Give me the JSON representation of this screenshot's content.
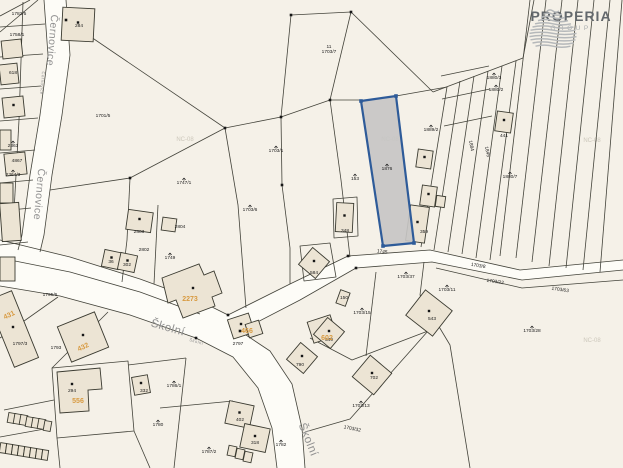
{
  "logo": {
    "name": "PROPERIA",
    "sub": "GROUP"
  },
  "map": {
    "colors": {
      "background": "#f5f1e8",
      "road_fill": "#fdfcf7",
      "parcel_line": "#43433a",
      "building_fill": "#ece4d4",
      "building_stroke": "#3a3a30",
      "label_black": "#1a1a1a",
      "label_orange": "#d89a40",
      "street_gray": "#909090",
      "watermark": "#ccc7bb",
      "highlight_fill": "#c7c6c4",
      "highlight_stroke": "#2e5b99"
    },
    "road_fills": [
      "M44,0 L66,0 L70,55 L62,115 L52,175 L44,235 L40,252 L18,250 L22,235 L30,175 L40,115 L48,55 Z",
      "M0,240 L70,257 L140,279 L200,301 L228,315 L290,284 L348,256 L356,268 L300,300 L240,331 L270,351 L292,384 L302,428 L305,468 L277,468 L272,428 L258,388 L233,357 L196,338 L130,315 L60,296 L0,286 Z",
      "M348,256 L430,250 L520,270 L623,260 L623,270 L522,280 L432,262 L356,268 Z"
    ],
    "lines": [
      "M44,0 L48,55 L40,115 L30,175 L22,235 L18,250",
      "M66,0 L70,55 L62,115 L52,175 L44,235 L40,252",
      "M0,240 L70,257 L140,279 L200,301 L228,315",
      "M0,286 L60,296 L130,315 L196,338",
      "M0,258 L70,272 L140,292 L200,314",
      "M228,315 L290,284 L348,256",
      "M240,331 L300,300 L356,268",
      "M196,338 L233,357 L258,388 L272,428 L277,468",
      "M240,331 L270,351 L292,384 L302,428 L305,468",
      "M348,256 L430,250 L520,270 L623,260",
      "M356,268 L432,262 L522,280 L623,270",
      "M0,27 L45,24",
      "M0,57 L43,54",
      "M0,89 L41,86",
      "M0,121 L38,118",
      "M0,153 L35,150",
      "M0,183 L33,180",
      "M0,211 L31,208",
      "M0,245 L28,242",
      "M23,2 L19,120",
      "M19,120 L13,230",
      "M0,16 L30,0",
      "M0,32 L38,0",
      "M291,15 L351,12 L330,100 L281,117 Z",
      "M66,20 L225,128",
      "M225,128 L281,117",
      "M330,100 L362,100",
      "M396,96 L447,87",
      "M351,12 L433,92",
      "M433,92 L523,58 L534,0",
      "M225,128 L130,178",
      "M130,178 L50,190",
      "M130,178 L127,240",
      "M127,240 L122,282",
      "M158,205 L154,284",
      "M225,128 L238,205 L246,308",
      "M281,117 L282,185 L290,248 L290,284",
      "M330,100 L341,180 L350,257",
      "M447,87 L421,247",
      "M460,81 L434,250",
      "M474,76 L448,252",
      "M488,71 L462,254",
      "M502,66 L476,258",
      "M516,61 L490,260",
      "M530,0 L500,256",
      "M546,0 L516,258",
      "M562,0 L532,262",
      "M578,0 L549,266",
      "M594,0 L566,268",
      "M610,0 L583,270",
      "M622,0 L600,272",
      "M441,76 L489,66",
      "M442,99 L490,89",
      "M444,126 L492,116",
      "M424,262 L420,295 L450,345 L470,468",
      "M376,272 L366,356",
      "M310,338 L352,360 L428,331",
      "M305,432 L350,419 L428,331",
      "M436,268 L522,288 L623,280",
      "M186,358 L174,468",
      "M128,365 L186,358",
      "M160,408 L233,401",
      "M52,368 L128,361 L134,431 L57,438 Z",
      "M134,431 L150,468",
      "M57,438 L60,468",
      "M58,297 L0,338",
      "M108,312 L52,368",
      "M4,410 L54,400",
      "M0,437 L50,428",
      "M300,246 L330,243 L336,277 L304,281 Z",
      "M333,199 L357,197 L358,236 L334,238 Z"
    ],
    "buildings": [
      {
        "x": 62,
        "y": 8,
        "w": 32,
        "h": 33,
        "rot": 3,
        "dot": 1
      },
      {
        "x": 2,
        "y": 40,
        "w": 20,
        "h": 18,
        "rot": -6
      },
      {
        "x": 0,
        "y": 64,
        "w": 18,
        "h": 20,
        "rot": -6
      },
      {
        "x": 3,
        "y": 97,
        "w": 21,
        "h": 20,
        "rot": -6,
        "dot": 1
      },
      {
        "x": 0,
        "y": 130,
        "w": 11,
        "h": 20,
        "rot": 0
      },
      {
        "x": 5,
        "y": 153,
        "w": 21,
        "h": 22,
        "rot": -6
      },
      {
        "x": 0,
        "y": 183,
        "w": 13,
        "h": 20,
        "rot": 0
      },
      {
        "x": 1,
        "y": 203,
        "w": 19,
        "h": 38,
        "rot": -4
      },
      {
        "x": 0,
        "y": 257,
        "w": 15,
        "h": 24,
        "rot": 0
      },
      {
        "x": 127,
        "y": 211,
        "w": 25,
        "h": 20,
        "rot": 8,
        "dot": 1
      },
      {
        "x": 162,
        "y": 218,
        "w": 14,
        "h": 13,
        "rot": 8
      },
      {
        "x": 103,
        "y": 251,
        "w": 17,
        "h": 17,
        "rot": 12,
        "dot": 1
      },
      {
        "x": 119,
        "y": 254,
        "w": 17,
        "h": 17,
        "rot": 12,
        "dot": 1
      },
      {
        "x": 417,
        "y": 150,
        "w": 15,
        "h": 18,
        "rot": 8,
        "dot": 1
      },
      {
        "x": 421,
        "y": 186,
        "w": 15,
        "h": 20,
        "rot": 8,
        "dot": 1
      },
      {
        "x": 408,
        "y": 206,
        "w": 19,
        "h": 36,
        "rot": 8,
        "dot": 1
      },
      {
        "x": 436,
        "y": 196,
        "w": 9,
        "h": 11,
        "rot": 8
      },
      {
        "x": 496,
        "y": 112,
        "w": 16,
        "h": 20,
        "rot": 8,
        "dot": 1
      },
      {
        "x": 336,
        "y": 203,
        "w": 17,
        "h": 29,
        "rot": 3,
        "dot": 1
      },
      {
        "x": 338,
        "y": 291,
        "w": 10,
        "h": 14,
        "rot": 20
      },
      {
        "x": 227,
        "y": 403,
        "w": 25,
        "h": 23,
        "rot": 12,
        "dot": 1
      },
      {
        "x": 242,
        "y": 426,
        "w": 26,
        "h": 24,
        "rot": 12,
        "dot": 1
      },
      {
        "x": 228,
        "y": 446,
        "w": 8,
        "h": 10,
        "rot": 12
      },
      {
        "x": 236,
        "y": 449,
        "w": 8,
        "h": 10,
        "rot": 12
      },
      {
        "x": 244,
        "y": 452,
        "w": 8,
        "h": 10,
        "rot": 12
      },
      {
        "x": 0,
        "y": 293,
        "w": 26,
        "h": 72,
        "rot": -22,
        "dot": 1
      },
      {
        "x": 63,
        "y": 318,
        "w": 40,
        "h": 38,
        "rot": -22,
        "dot": 1
      },
      {
        "x": 133,
        "y": 376,
        "w": 16,
        "h": 18,
        "rot": -10,
        "dot": 1
      },
      {
        "x": 230,
        "y": 316,
        "w": 22,
        "h": 20,
        "rot": -18,
        "dot": 1
      },
      {
        "x": 247,
        "y": 322,
        "w": 14,
        "h": 14,
        "rot": -18
      },
      {
        "x": 310,
        "y": 318,
        "w": 24,
        "h": 22,
        "rot": -18,
        "dot": 1
      },
      {
        "x": 291,
        "y": 347,
        "w": 22,
        "h": 22,
        "rot": 40,
        "dot": 1
      },
      {
        "x": 303,
        "y": 252,
        "w": 22,
        "h": 22,
        "rot": 40,
        "dot": 1
      },
      {
        "x": 412,
        "y": 297,
        "w": 34,
        "h": 32,
        "rot": 38,
        "dot": 1
      },
      {
        "x": 318,
        "y": 322,
        "w": 22,
        "h": 22,
        "rot": 40,
        "dot": 1
      },
      {
        "x": 358,
        "y": 361,
        "w": 28,
        "h": 28,
        "rot": 40,
        "dot": 1
      },
      {
        "x": 8,
        "y": 413,
        "w": 7,
        "h": 10,
        "rot": 10
      },
      {
        "x": 14,
        "y": 414,
        "w": 7,
        "h": 10,
        "rot": 10
      },
      {
        "x": 20,
        "y": 415,
        "w": 7,
        "h": 10,
        "rot": 10
      },
      {
        "x": 26,
        "y": 417,
        "w": 7,
        "h": 10,
        "rot": 10
      },
      {
        "x": 32,
        "y": 418,
        "w": 7,
        "h": 10,
        "rot": 10
      },
      {
        "x": 38,
        "y": 419,
        "w": 7,
        "h": 10,
        "rot": 10
      },
      {
        "x": 44,
        "y": 421,
        "w": 7,
        "h": 10,
        "rot": 10
      },
      {
        "x": 0,
        "y": 443,
        "w": 6,
        "h": 10,
        "rot": 8
      },
      {
        "x": 6,
        "y": 444,
        "w": 6,
        "h": 10,
        "rot": 8
      },
      {
        "x": 12,
        "y": 445,
        "w": 6,
        "h": 10,
        "rot": 8
      },
      {
        "x": 18,
        "y": 446,
        "w": 6,
        "h": 10,
        "rot": 8
      },
      {
        "x": 24,
        "y": 447,
        "w": 6,
        "h": 10,
        "rot": 8
      },
      {
        "x": 30,
        "y": 448,
        "w": 6,
        "h": 10,
        "rot": 8
      },
      {
        "x": 36,
        "y": 449,
        "w": 6,
        "h": 10,
        "rot": 8
      },
      {
        "x": 42,
        "y": 450,
        "w": 6,
        "h": 10,
        "rot": 8
      }
    ],
    "building_polys": [
      {
        "d": "M162,278 L199,264 L204,275 L214,271 L222,293 L212,297 L215,306 L183,318 L176,300 L168,303 Z",
        "dot_x": 193,
        "dot_y": 288
      },
      {
        "d": "M57,372 L100,368 L102,389 L88,390 L89,411 L60,413 Z",
        "dot_x": 72,
        "dot_y": 384
      }
    ],
    "vertices": [
      [
        291,
        15
      ],
      [
        351,
        12
      ],
      [
        330,
        100
      ],
      [
        281,
        117
      ],
      [
        225,
        128
      ],
      [
        66,
        20
      ],
      [
        228,
        315
      ],
      [
        240,
        331
      ],
      [
        348,
        256
      ],
      [
        356,
        268
      ],
      [
        196,
        338
      ],
      [
        282,
        185
      ],
      [
        130,
        178
      ]
    ],
    "highlight": {
      "points": "361,101 396,96 414,243 383,246",
      "nodes": [
        [
          361,
          101
        ],
        [
          396,
          96
        ],
        [
          414,
          243
        ],
        [
          383,
          246
        ]
      ]
    }
  },
  "streets": [
    {
      "text": "Černovice",
      "x": 49,
      "y": 40,
      "rot": 95,
      "size": 10.5
    },
    {
      "text": "Černovice",
      "x": 36,
      "y": 194,
      "rot": 95,
      "size": 10.5
    },
    {
      "text": "Černovice",
      "x": 41,
      "y": 83,
      "rot": 95,
      "size": 4.2
    },
    {
      "text": "Školní",
      "x": 167,
      "y": 331,
      "rot": 16,
      "size": 11.5
    },
    {
      "text": "Školní",
      "x": 196,
      "y": 343,
      "rot": 16,
      "size": 4.2
    },
    {
      "text": "Školní",
      "x": 305,
      "y": 441,
      "rot": 68,
      "size": 11.5
    }
  ],
  "watermarks": [
    {
      "text": "NC-08",
      "x": 185,
      "y": 141
    },
    {
      "text": "NC-08",
      "x": 390,
      "y": 141
    },
    {
      "text": "NC-08",
      "x": 592,
      "y": 142
    },
    {
      "text": "NC-08",
      "x": 592,
      "y": 342
    }
  ],
  "labels": [
    {
      "t": [
        "1782/5"
      ],
      "x": 19,
      "y": 15
    },
    {
      "t": [
        "1758/1"
      ],
      "x": 17,
      "y": 36
    },
    {
      "t": [
        "284"
      ],
      "x": 79,
      "y": 27
    },
    {
      "t": [
        "618"
      ],
      "x": 13,
      "y": 74
    },
    {
      "t": [
        "1701/5"
      ],
      "x": 103,
      "y": 117
    },
    {
      "t": [
        "2363"
      ],
      "x": 13,
      "y": 147,
      "sym": 1
    },
    {
      "t": [
        "4867"
      ],
      "x": 17,
      "y": 162
    },
    {
      "t": [
        "2364/3"
      ],
      "x": 13,
      "y": 176,
      "sym": 1
    },
    {
      "t": [
        "1747/1"
      ],
      "x": 184,
      "y": 184,
      "sym": 1
    },
    {
      "t": [
        "1703/1"
      ],
      "x": 276,
      "y": 152,
      "sym": 1
    },
    {
      "t": [
        "11",
        "1703/7"
      ],
      "x": 329,
      "y": 48
    },
    {
      "t": [
        "153"
      ],
      "x": 355,
      "y": 180,
      "sym": 1
    },
    {
      "t": [
        "1876"
      ],
      "x": 387,
      "y": 170,
      "sym": 1,
      "cls": "hl"
    },
    {
      "t": [
        "1889/2"
      ],
      "x": 431,
      "y": 131,
      "sym": 1
    },
    {
      "t": [
        "348"
      ],
      "x": 345,
      "y": 232
    },
    {
      "t": [
        "1880/3"
      ],
      "x": 494,
      "y": 79,
      "sym": 1
    },
    {
      "t": [
        "1880/2"
      ],
      "x": 496,
      "y": 91,
      "sym": 1
    },
    {
      "t": [
        "441"
      ],
      "x": 504,
      "y": 137
    },
    {
      "t": [
        "1884"
      ],
      "x": 470,
      "y": 146,
      "rot": 78
    },
    {
      "t": [
        "1845"
      ],
      "x": 486,
      "y": 152,
      "rot": 78
    },
    {
      "t": [
        "1880/7"
      ],
      "x": 510,
      "y": 178,
      "sym": 1
    },
    {
      "t": [
        "359"
      ],
      "x": 424,
      "y": 233
    },
    {
      "t": [
        "1745"
      ],
      "x": 382,
      "y": 253,
      "rot": 8
    },
    {
      "t": [
        "1703/37"
      ],
      "x": 406,
      "y": 278,
      "sym": 1
    },
    {
      "t": [
        "1703/11"
      ],
      "x": 447,
      "y": 291,
      "sym": 1
    },
    {
      "t": [
        "1703/8"
      ],
      "x": 478,
      "y": 267,
      "rot": 10
    },
    {
      "t": [
        "1703/22"
      ],
      "x": 495,
      "y": 283,
      "rot": 8
    },
    {
      "t": [
        "1703/63"
      ],
      "x": 560,
      "y": 291,
      "rot": 8
    },
    {
      "t": [
        "1703/28"
      ],
      "x": 532,
      "y": 332,
      "sym": 1
    },
    {
      "t": [
        "584"
      ],
      "x": 314,
      "y": 274
    },
    {
      "t": [
        "150"
      ],
      "x": 344,
      "y": 299
    },
    {
      "t": [
        "1703/15"
      ],
      "x": 362,
      "y": 314,
      "sym": 1
    },
    {
      "t": [
        "1703/6"
      ],
      "x": 250,
      "y": 211,
      "sym": 1
    },
    {
      "t": [
        "543"
      ],
      "x": 432,
      "y": 320
    },
    {
      "t": [
        "549"
      ],
      "x": 329,
      "y": 341
    },
    {
      "t": [
        "790"
      ],
      "x": 300,
      "y": 366
    },
    {
      "t": [
        "702"
      ],
      "x": 374,
      "y": 379
    },
    {
      "t": [
        "1703/13"
      ],
      "x": 361,
      "y": 407,
      "sym": 1
    },
    {
      "t": [
        "1703/32"
      ],
      "x": 352,
      "y": 430,
      "rot": 12
    },
    {
      "t": [
        "1782"
      ],
      "x": 281,
      "y": 446,
      "sym": 1
    },
    {
      "t": [
        "1787/2"
      ],
      "x": 209,
      "y": 453,
      "sym": 1
    },
    {
      "t": [
        "1780"
      ],
      "x": 158,
      "y": 426,
      "sym": 1
    },
    {
      "t": [
        "1786/1"
      ],
      "x": 174,
      "y": 387,
      "sym": 1
    },
    {
      "t": [
        "402"
      ],
      "x": 240,
      "y": 421
    },
    {
      "t": [
        "318"
      ],
      "x": 255,
      "y": 444
    },
    {
      "t": [
        "2803"
      ],
      "x": 139,
      "y": 233
    },
    {
      "t": [
        "2804"
      ],
      "x": 180,
      "y": 228
    },
    {
      "t": [
        "2802"
      ],
      "x": 144,
      "y": 251
    },
    {
      "t": [
        "1749"
      ],
      "x": 170,
      "y": 259,
      "sym": 1
    },
    {
      "t": [
        "36"
      ],
      "x": 111,
      "y": 263
    },
    {
      "t": [
        "302"
      ],
      "x": 127,
      "y": 266
    },
    {
      "t": [
        "2797"
      ],
      "x": 238,
      "y": 345
    },
    {
      "t": [
        "1795/6"
      ],
      "x": 50,
      "y": 296
    },
    {
      "t": [
        "1793"
      ],
      "x": 56,
      "y": 349
    },
    {
      "t": [
        "1797/3"
      ],
      "x": 20,
      "y": 345
    },
    {
      "t": [
        "294"
      ],
      "x": 72,
      "y": 392
    },
    {
      "t": [
        "332"
      ],
      "x": 144,
      "y": 392
    }
  ],
  "orange_labels": [
    {
      "t": "431",
      "x": 10,
      "y": 317,
      "rot": -25
    },
    {
      "t": "432",
      "x": 84,
      "y": 349,
      "rot": -25
    },
    {
      "t": "556",
      "x": 78,
      "y": 403,
      "rot": 0
    },
    {
      "t": "2273",
      "x": 190,
      "y": 301,
      "rot": 0
    },
    {
      "t": "466",
      "x": 247,
      "y": 333,
      "rot": 0
    },
    {
      "t": "602",
      "x": 327,
      "y": 340,
      "rot": 0
    }
  ]
}
